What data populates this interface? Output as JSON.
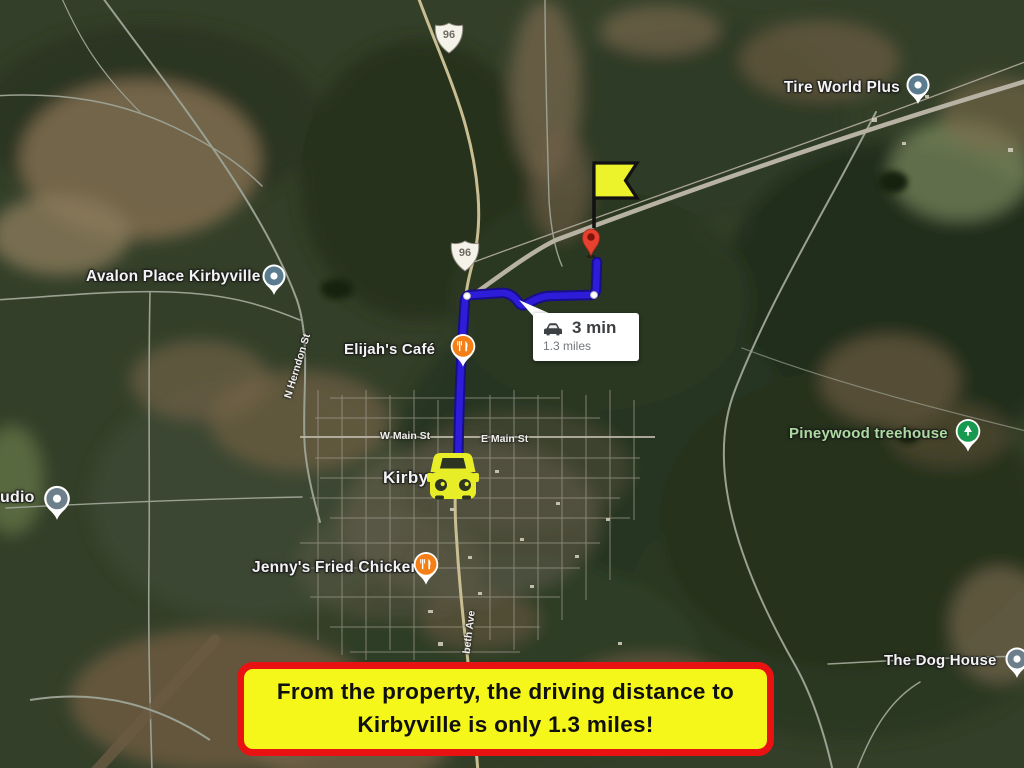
{
  "banner": {
    "line1": "From the property, the driving distance to",
    "line2": "Kirbyville is only 1.3 miles!"
  },
  "route_summary": {
    "duration": "3 min",
    "distance": "1.3 miles"
  },
  "town": {
    "label": "Kirbyville"
  },
  "pois": {
    "tire_world": {
      "label": "Tire World Plus",
      "type": "place"
    },
    "avalon": {
      "label": "Avalon Place Kirbyville",
      "type": "place"
    },
    "studio": {
      "label": "udio",
      "type": "place"
    },
    "elijahs": {
      "label": "Elijah's Café",
      "type": "restaurant"
    },
    "jennys": {
      "label": "Jenny's Fried Chicken",
      "type": "restaurant"
    },
    "pineywood": {
      "label": "Pineywood treehouse",
      "type": "park-lodging"
    },
    "dog_house": {
      "label": "The Dog House",
      "type": "place"
    }
  },
  "streets": {
    "w_main": "W Main St",
    "e_main": "E Main St",
    "herndon": "N Herndon St",
    "elizabeth": "beth Ave"
  },
  "highway": {
    "shield": "96"
  },
  "colors": {
    "route_blue": "#2d1cd8",
    "route_outline": "#180e8c",
    "banner_bg": "#f5f71a",
    "banner_border": "#e91212",
    "flag_yellow": "#edf32b",
    "car_yellow": "#e7ee27",
    "destination_pin": "#e8402f",
    "poi_gray": "#5b7c8e",
    "poi_orange": "#f57f17",
    "poi_green": "#17994f",
    "park_label_green": "#abdb9e"
  }
}
